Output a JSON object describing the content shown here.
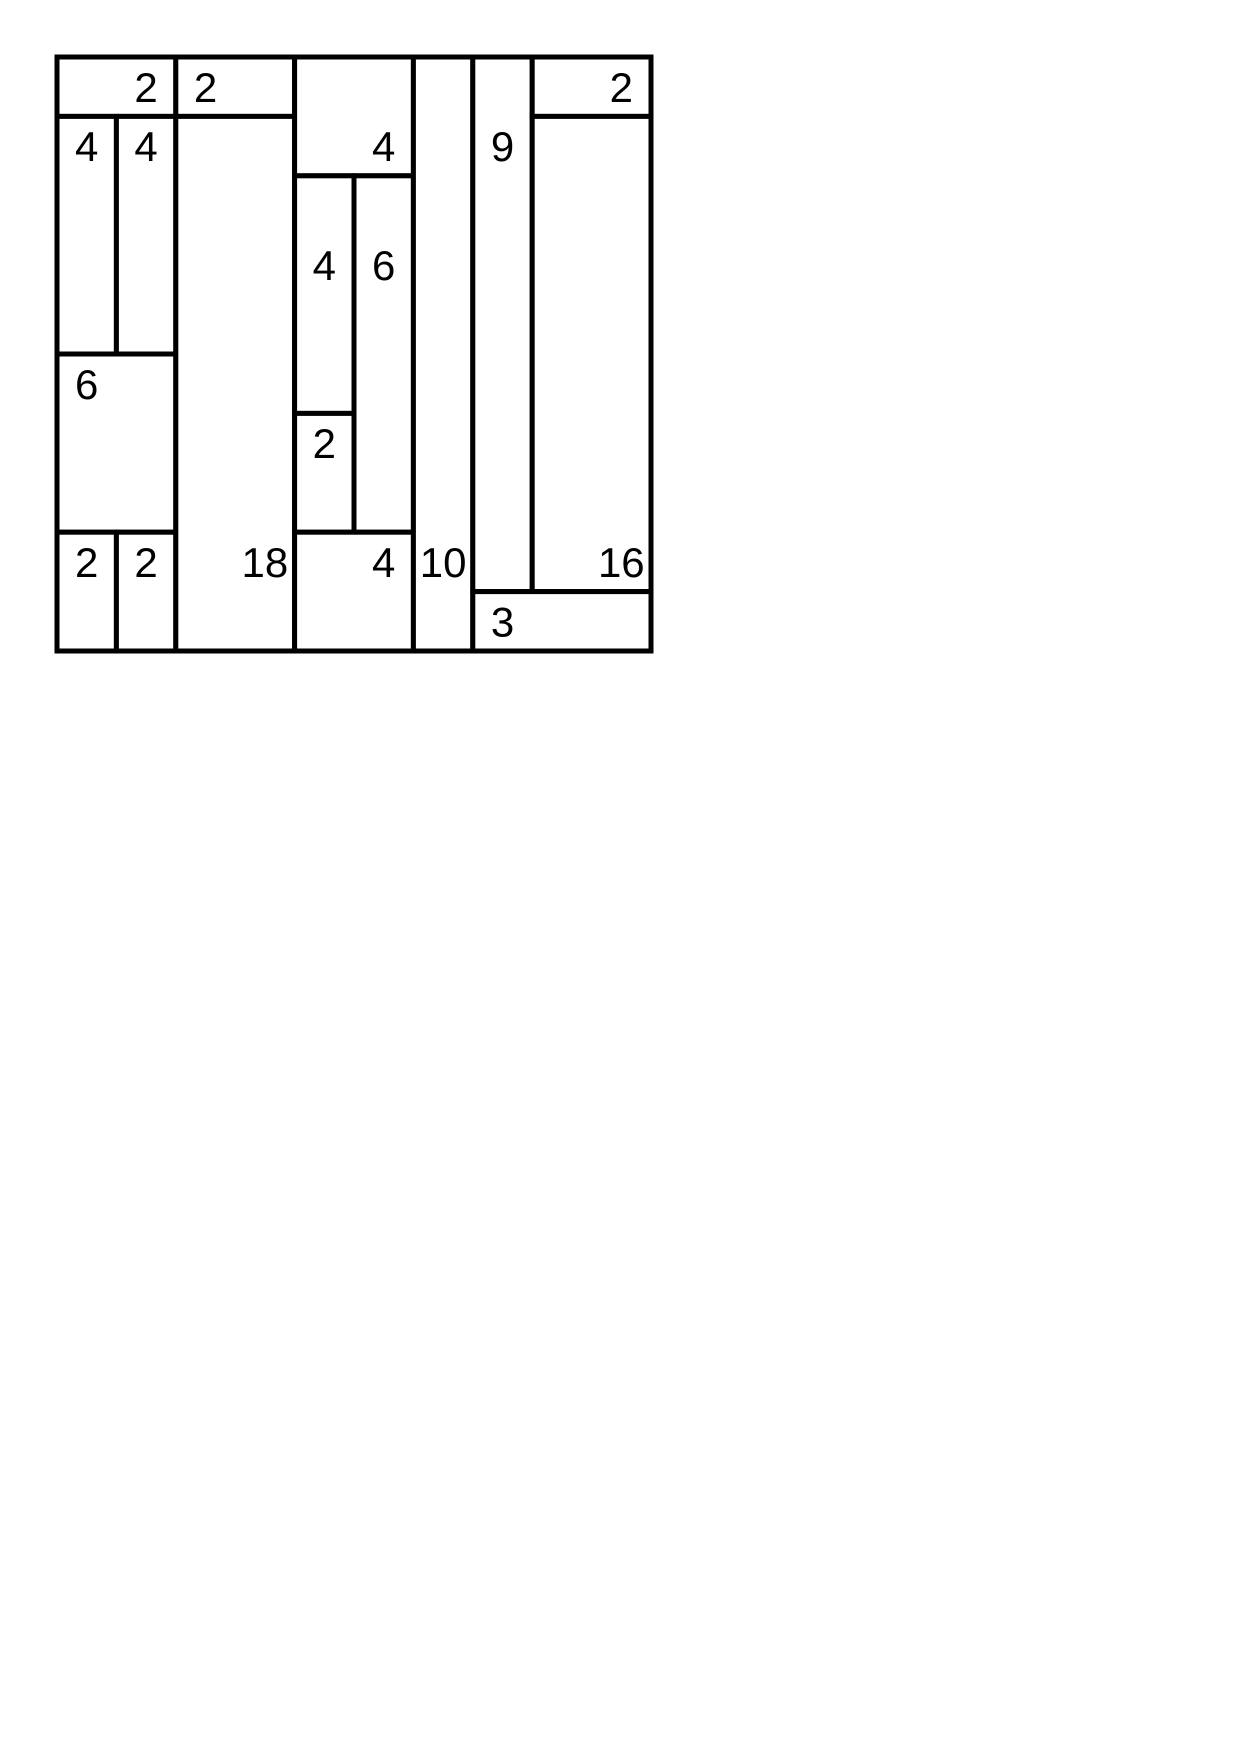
{
  "canvas": {
    "width": 1240,
    "height": 1754,
    "background": "#ffffff"
  },
  "puzzle": {
    "kind": "shikaku-solution-grid",
    "grid": {
      "cols": 10,
      "rows": 10,
      "origin_x": 57,
      "origin_y": 57,
      "cell_size": 59.4,
      "line_color": "#000000",
      "line_width": 5,
      "cell_fill": "#ffffff",
      "label_color": "#000000",
      "label_font_size": 42
    },
    "rects": [
      {
        "col": 0,
        "row": 0,
        "w": 2,
        "h": 1,
        "value": 2,
        "clue_col": 1,
        "clue_row": 0
      },
      {
        "col": 2,
        "row": 0,
        "w": 2,
        "h": 1,
        "value": 2,
        "clue_col": 2,
        "clue_row": 0
      },
      {
        "col": 0,
        "row": 1,
        "w": 1,
        "h": 4,
        "value": 4,
        "clue_col": 0,
        "clue_row": 1
      },
      {
        "col": 1,
        "row": 1,
        "w": 1,
        "h": 4,
        "value": 4,
        "clue_col": 1,
        "clue_row": 1
      },
      {
        "col": 0,
        "row": 5,
        "w": 2,
        "h": 3,
        "value": 6,
        "clue_col": 0,
        "clue_row": 5
      },
      {
        "col": 0,
        "row": 8,
        "w": 1,
        "h": 2,
        "value": 2,
        "clue_col": 0,
        "clue_row": 8
      },
      {
        "col": 1,
        "row": 8,
        "w": 1,
        "h": 2,
        "value": 2,
        "clue_col": 1,
        "clue_row": 8
      },
      {
        "col": 2,
        "row": 1,
        "w": 2,
        "h": 9,
        "value": 18,
        "clue_col": 3,
        "clue_row": 8
      },
      {
        "col": 4,
        "row": 0,
        "w": 2,
        "h": 2,
        "value": 4,
        "clue_col": 5,
        "clue_row": 1
      },
      {
        "col": 4,
        "row": 2,
        "w": 1,
        "h": 4,
        "value": 4,
        "clue_col": 4,
        "clue_row": 3
      },
      {
        "col": 5,
        "row": 2,
        "w": 1,
        "h": 6,
        "value": 6,
        "clue_col": 5,
        "clue_row": 3
      },
      {
        "col": 4,
        "row": 6,
        "w": 1,
        "h": 2,
        "value": 2,
        "clue_col": 4,
        "clue_row": 6
      },
      {
        "col": 4,
        "row": 8,
        "w": 2,
        "h": 2,
        "value": 4,
        "clue_col": 5,
        "clue_row": 8
      },
      {
        "col": 6,
        "row": 0,
        "w": 1,
        "h": 10,
        "value": 10,
        "clue_col": 6,
        "clue_row": 8
      },
      {
        "col": 7,
        "row": 0,
        "w": 1,
        "h": 9,
        "value": 9,
        "clue_col": 7,
        "clue_row": 1
      },
      {
        "col": 8,
        "row": 0,
        "w": 2,
        "h": 1,
        "value": 2,
        "clue_col": 9,
        "clue_row": 0
      },
      {
        "col": 8,
        "row": 1,
        "w": 2,
        "h": 8,
        "value": 16,
        "clue_col": 9,
        "clue_row": 8
      },
      {
        "col": 7,
        "row": 9,
        "w": 3,
        "h": 1,
        "value": 3,
        "clue_col": 7,
        "clue_row": 9
      }
    ]
  }
}
